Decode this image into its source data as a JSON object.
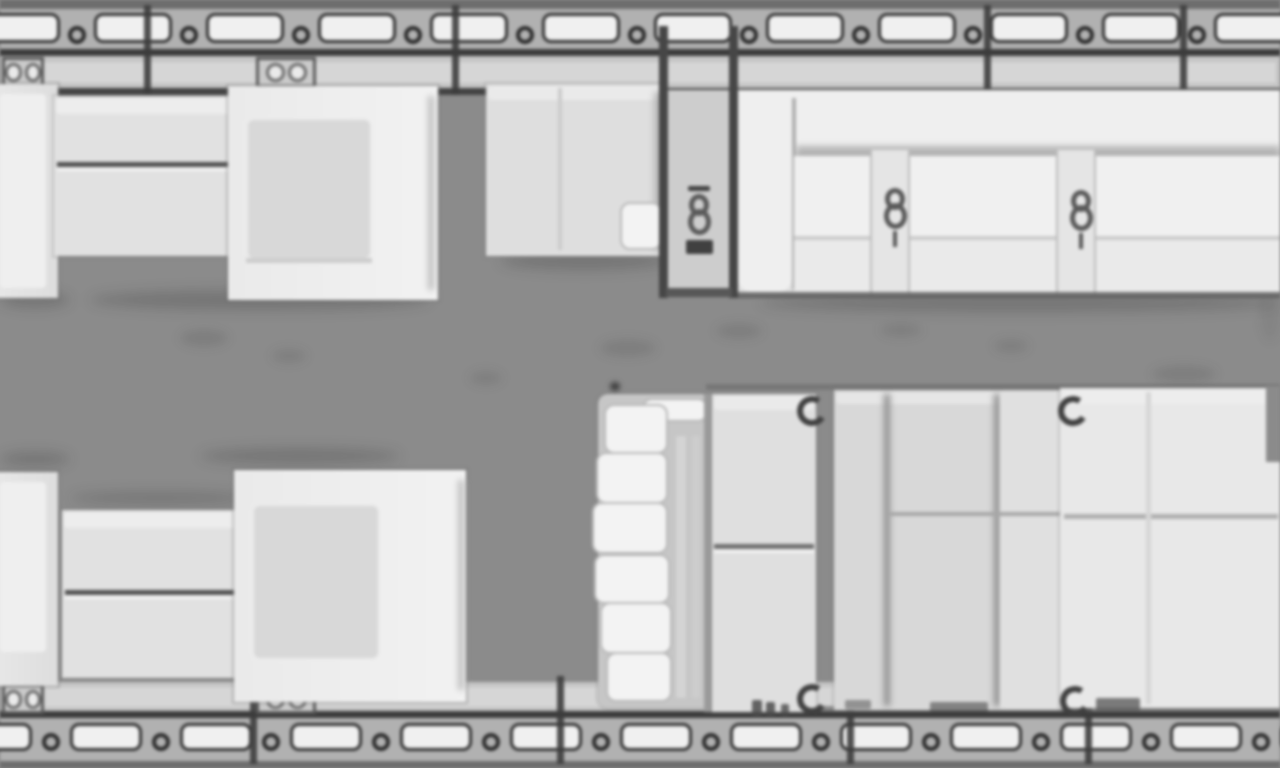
{
  "meta": {
    "description": "Top-down floor plan of a business-jet cabin (blurry upscaled grayscale plan, no text)",
    "orientation": "horizontal fuselage, windows along top and bottom walls"
  },
  "palette": {
    "floor": "#8b8b8b",
    "wall_dark": "#3b3b3b",
    "window_band": "#b2b2b2",
    "window_fill": "#f2f2f2",
    "sill": "#c6c6c6",
    "furniture_light": "#eeeeee",
    "furniture_mid": "#dadada",
    "partition": "#454545"
  },
  "plan": {
    "width": 1280,
    "height": 768,
    "windows": {
      "top": {
        "y": 13,
        "h": 30,
        "start": -18,
        "pitch": 112,
        "width": 78,
        "count": 12,
        "bracket_y": 26
      },
      "bottom": {
        "y": 723,
        "h": 28,
        "start": -40,
        "pitch": 110,
        "width": 72,
        "count": 13,
        "bracket_y": 733
      }
    },
    "frames": {
      "top": {
        "y": 5,
        "h": 90,
        "w": 7,
        "xs": [
          144,
          452,
          984,
          1180
        ]
      },
      "bottom": {
        "y": 676,
        "h": 88,
        "w": 7,
        "xs": [
          250,
          557,
          847,
          1085
        ]
      }
    },
    "base": [
      {
        "n": "fuselage-top-outer-edge",
        "k": "rect",
        "x": 0,
        "y": 0,
        "w": 1280,
        "h": 9,
        "bg": "#6d6d6d"
      },
      {
        "n": "fuselage-top-window-band",
        "k": "rect",
        "x": 0,
        "y": 9,
        "w": 1280,
        "h": 42,
        "bg": "#b2b2b2"
      },
      {
        "n": "fuselage-top-wall-line",
        "k": "rect",
        "x": 0,
        "y": 49,
        "w": 1280,
        "h": 8,
        "bg": "#3b3b3b"
      },
      {
        "n": "fuselage-top-sill",
        "k": "rect",
        "x": 0,
        "y": 56,
        "w": 1280,
        "h": 34,
        "bg": "#c6c6c6"
      },
      {
        "n": "fuselage-top-sill-inner",
        "k": "rect",
        "x": 4,
        "y": 62,
        "w": 1272,
        "h": 21,
        "bg": "#d8d8d8"
      },
      {
        "n": "fuselage-top-inner-line",
        "k": "rect",
        "x": 0,
        "y": 88,
        "w": 1280,
        "h": 7,
        "bg": "#424242"
      },
      {
        "n": "fuselage-bottom-sill",
        "k": "rect",
        "x": 0,
        "y": 682,
        "w": 1280,
        "h": 31,
        "bg": "#c6c6c6"
      },
      {
        "n": "fuselage-bottom-sill-inner",
        "k": "rect",
        "x": 4,
        "y": 687,
        "w": 1272,
        "h": 20,
        "bg": "#d8d8d8"
      },
      {
        "n": "fuselage-bottom-wall-line",
        "k": "rect",
        "x": 0,
        "y": 711,
        "w": 1280,
        "h": 8,
        "bg": "#3b3b3b"
      },
      {
        "n": "fuselage-bottom-window-band",
        "k": "rect",
        "x": 0,
        "y": 718,
        "w": 1280,
        "h": 45,
        "bg": "#b2b2b2"
      },
      {
        "n": "fuselage-bottom-outer-edge",
        "k": "rect",
        "x": 0,
        "y": 761,
        "w": 1280,
        "h": 7,
        "bg": "#6d6d6d"
      }
    ],
    "fittings": [
      {
        "n": "sidewall-fitting-top-left",
        "k": "fit",
        "x": 2,
        "y": 57,
        "w": 42,
        "h": 31
      },
      {
        "n": "sidewall-fitting-top-mid",
        "k": "fit",
        "x": 256,
        "y": 57,
        "w": 60,
        "h": 31
      },
      {
        "n": "sidewall-fitting-bottom-left",
        "k": "fit",
        "x": 2,
        "y": 684,
        "w": 42,
        "h": 30
      },
      {
        "n": "sidewall-fitting-bottom-mid",
        "k": "fit",
        "x": 256,
        "y": 684,
        "w": 60,
        "h": 30
      }
    ],
    "smudges": [
      {
        "n": "floor-smudge",
        "k": "smudge",
        "x": 180,
        "y": 330,
        "w": 48,
        "h": 16
      },
      {
        "n": "floor-smudge",
        "k": "smudge",
        "x": 272,
        "y": 350,
        "w": 34,
        "h": 12
      },
      {
        "n": "floor-smudge",
        "k": "smudge",
        "x": 470,
        "y": 372,
        "w": 32,
        "h": 12
      },
      {
        "n": "floor-smudge",
        "k": "smudge",
        "x": 600,
        "y": 340,
        "w": 56,
        "h": 16
      },
      {
        "n": "floor-smudge",
        "k": "smudge",
        "x": 716,
        "y": 324,
        "w": 46,
        "h": 14
      },
      {
        "n": "floor-smudge",
        "k": "smudge",
        "x": 880,
        "y": 324,
        "w": 42,
        "h": 12
      },
      {
        "n": "floor-smudge",
        "k": "smudge",
        "x": 994,
        "y": 340,
        "w": 34,
        "h": 12
      },
      {
        "n": "floor-smudge",
        "k": "smudge",
        "x": 1152,
        "y": 366,
        "w": 64,
        "h": 16
      },
      {
        "n": "floor-smudge",
        "k": "smudge",
        "x": 1260,
        "y": 282,
        "w": 20,
        "h": 60,
        "o": 0.5
      },
      {
        "n": "floor-speck",
        "k": "dot",
        "x": 610,
        "y": 382,
        "w": 10,
        "h": 9
      }
    ],
    "shadows": [
      {
        "n": "shadow-under-forward-table",
        "k": "shadow",
        "x": 90,
        "y": 290,
        "w": 340,
        "h": 20
      },
      {
        "n": "shadow-under-credenza",
        "k": "shadow",
        "x": 500,
        "y": 252,
        "w": 170,
        "h": 18
      },
      {
        "n": "shadow-under-divan",
        "k": "shadow",
        "x": 760,
        "y": 294,
        "w": 520,
        "h": 18
      },
      {
        "n": "shadow-above-aft-seat",
        "k": "shadow",
        "x": 200,
        "y": 448,
        "w": 200,
        "h": 16
      },
      {
        "n": "shadow-under-forward-left-seat",
        "k": "shadow",
        "x": 0,
        "y": 292,
        "w": 70,
        "h": 16
      },
      {
        "n": "shadow-above-aft-left-seat",
        "k": "shadow",
        "x": 0,
        "y": 452,
        "w": 70,
        "h": 14
      },
      {
        "n": "shadow-above-aft-table",
        "k": "shadow",
        "x": 70,
        "y": 492,
        "w": 180,
        "h": 12
      },
      {
        "n": "edge-line-above-bed-group",
        "k": "rect",
        "x": 706,
        "y": 384,
        "w": 574,
        "h": 6,
        "bg": "#6a6a6a",
        "o": 0.6
      },
      {
        "n": "edge-line-below-bed-group",
        "k": "rect",
        "x": 706,
        "y": 706,
        "w": 574,
        "h": 6,
        "bg": "#5f5f5f",
        "o": 0.6
      }
    ],
    "furniture": [
      {
        "n": "forward-left-seat-shell",
        "k": "shell",
        "x": -48,
        "y": 84,
        "w": 106,
        "h": 214,
        "r": "0 24 24 0",
        "bg": "linear-gradient(90deg,#f0f0f0,#dfdfdf)"
      },
      {
        "n": "forward-left-seat-cushion",
        "k": "bright",
        "x": 0,
        "y": 94,
        "w": 46,
        "h": 194,
        "o": 0.95
      },
      {
        "n": "forward-table-edge-shadow",
        "k": "soft",
        "x": 242,
        "y": 104,
        "w": 16,
        "h": 150,
        "bg": "#858585",
        "o": 0.6
      },
      {
        "n": "forward-table-top",
        "k": "panel",
        "x": 54,
        "y": 96,
        "w": 192,
        "h": 160,
        "bg": "#e3e3e3"
      },
      {
        "n": "forward-table-highlight",
        "k": "bright",
        "x": 56,
        "y": 98,
        "w": 188,
        "h": 16,
        "o": 0.8
      },
      {
        "n": "forward-table-split-seam",
        "k": "seam",
        "x": 57,
        "y": 162,
        "w": 186,
        "h": 5
      },
      {
        "n": "forward-table-split-light",
        "k": "seamlight",
        "x": 57,
        "y": 167,
        "w": 186,
        "h": 4
      },
      {
        "n": "forward-club-seat-shell",
        "k": "shell",
        "x": 228,
        "y": 86,
        "w": 210,
        "h": 214,
        "r": "12 28 28 12",
        "bg": "linear-gradient(90deg,#ececec,#f4f4f4)"
      },
      {
        "n": "forward-club-seat-cushion",
        "k": "cushion",
        "x": 246,
        "y": 118,
        "w": 126,
        "h": 142
      },
      {
        "n": "forward-club-seat-backline",
        "k": "soft",
        "x": 428,
        "y": 96,
        "w": 6,
        "h": 194,
        "bg": "#c0c0c0"
      },
      {
        "n": "forward-club-seat-frontline",
        "k": "rect",
        "x": 246,
        "y": 258,
        "w": 126,
        "h": 5,
        "bg": "#cfcfcf"
      },
      {
        "n": "galley-credenza",
        "k": "panel",
        "x": 486,
        "y": 84,
        "w": 178,
        "h": 172,
        "bg": "#e0e0e0"
      },
      {
        "n": "galley-credenza-highlight",
        "k": "bright",
        "x": 488,
        "y": 86,
        "w": 174,
        "h": 14,
        "o": 0.7
      },
      {
        "n": "galley-credenza-edge-shadow",
        "k": "soft",
        "x": 654,
        "y": 92,
        "w": 14,
        "h": 158,
        "bg": "#9a9a9a",
        "o": 0.6
      },
      {
        "n": "galley-credenza-seam",
        "k": "rect",
        "x": 558,
        "y": 88,
        "w": 4,
        "h": 162,
        "bg": "#cdcdcd"
      },
      {
        "n": "galley-credenza-cabinet-door",
        "k": "step",
        "x": 620,
        "y": 202,
        "w": 42,
        "h": 48
      },
      {
        "n": "emergency-exit-bay",
        "k": "rect",
        "x": 668,
        "y": 90,
        "w": 66,
        "h": 206,
        "bg": "#cfcfcf"
      },
      {
        "n": "divan-base",
        "k": "panel",
        "x": 736,
        "y": 90,
        "w": 544,
        "h": 206,
        "bg": "#e4e4e4"
      },
      {
        "n": "divan-backrest",
        "k": "bright",
        "x": 736,
        "y": 90,
        "w": 544,
        "h": 62,
        "o": 1
      },
      {
        "n": "divan-back-crease",
        "k": "soft",
        "x": 796,
        "y": 146,
        "w": 484,
        "h": 14,
        "bg": "#a8a8a8",
        "o": 0.8
      },
      {
        "n": "divan-armrest-left",
        "k": "bright",
        "x": 738,
        "y": 94,
        "w": 54,
        "h": 198,
        "r": "14",
        "o": 1
      },
      {
        "n": "divan-armrest-seam",
        "k": "rect",
        "x": 792,
        "y": 98,
        "w": 4,
        "h": 192,
        "bg": "#b0b0b0"
      },
      {
        "n": "divan-seat-cushion",
        "k": "rect",
        "x": 794,
        "y": 156,
        "w": 486,
        "h": 80,
        "bg": "#f2f2f2"
      },
      {
        "n": "divan-front-edge-line",
        "k": "rect",
        "x": 794,
        "y": 236,
        "w": 486,
        "h": 4,
        "bg": "#cdcdcd"
      },
      {
        "n": "divan-front-rail",
        "k": "rect",
        "x": 794,
        "y": 240,
        "w": 486,
        "h": 52,
        "bg": "#ececec"
      },
      {
        "n": "divan-seat-divider-1",
        "k": "divider",
        "x": 870,
        "y": 150,
        "w": 40,
        "h": 144
      },
      {
        "n": "divan-seat-divider-2",
        "k": "divider",
        "x": 1056,
        "y": 150,
        "w": 40,
        "h": 144
      },
      {
        "n": "divan-bottom-line",
        "k": "rect",
        "x": 736,
        "y": 292,
        "w": 544,
        "h": 6,
        "bg": "#565656",
        "o": 0.8
      },
      {
        "n": "aft-left-seat-shell",
        "k": "shell",
        "x": -48,
        "y": 472,
        "w": 106,
        "h": 214,
        "r": "0 24 24 0",
        "bg": "linear-gradient(90deg,#f0f0f0,#dfdfdf)"
      },
      {
        "n": "aft-left-seat-cushion",
        "k": "bright",
        "x": 0,
        "y": 482,
        "w": 46,
        "h": 170,
        "o": 0.95
      },
      {
        "n": "aft-table-edge-shadow",
        "k": "soft",
        "x": 240,
        "y": 516,
        "w": 16,
        "h": 150,
        "bg": "#858585",
        "o": 0.6
      },
      {
        "n": "aft-table-top",
        "k": "panel",
        "x": 62,
        "y": 510,
        "w": 184,
        "h": 168,
        "bg": "#e3e3e3"
      },
      {
        "n": "aft-table-highlight",
        "k": "bright",
        "x": 64,
        "y": 512,
        "w": 180,
        "h": 16,
        "o": 0.8
      },
      {
        "n": "aft-table-split-seam",
        "k": "seam",
        "x": 65,
        "y": 590,
        "w": 178,
        "h": 5
      },
      {
        "n": "aft-table-split-light",
        "k": "seamlight",
        "x": 65,
        "y": 595,
        "w": 178,
        "h": 4
      },
      {
        "n": "aft-club-seat-shell",
        "k": "shell",
        "x": 234,
        "y": 470,
        "w": 232,
        "h": 232,
        "r": "12 30 30 12",
        "bg": "linear-gradient(90deg,#ececec,#f4f4f4)"
      },
      {
        "n": "aft-club-seat-cushion",
        "k": "cushion",
        "x": 252,
        "y": 504,
        "w": 128,
        "h": 156
      },
      {
        "n": "aft-club-seat-backline",
        "k": "soft",
        "x": 458,
        "y": 480,
        "w": 6,
        "h": 210,
        "bg": "#c0c0c0"
      },
      {
        "n": "stair-unit-base",
        "k": "panel",
        "x": 598,
        "y": 394,
        "w": 114,
        "h": 314,
        "bg": "#c7c7c7",
        "r": "10"
      },
      {
        "n": "stair-unit-stripe",
        "k": "rect",
        "x": 676,
        "y": 436,
        "w": 10,
        "h": 262,
        "bg": "#d6d6d6"
      },
      {
        "n": "stair-unit-stripe",
        "k": "rect",
        "x": 692,
        "y": 436,
        "w": 8,
        "h": 262,
        "bg": "#cfcfcf"
      },
      {
        "n": "stair-top-cap",
        "k": "step",
        "x": 642,
        "y": 398,
        "w": 66,
        "h": 24
      },
      {
        "n": "stair-step-1",
        "k": "step",
        "x": 604,
        "y": 404,
        "w": 64,
        "h": 50
      },
      {
        "n": "stair-step-2",
        "k": "step",
        "x": 596,
        "y": 452,
        "w": 72,
        "h": 52
      },
      {
        "n": "stair-step-3",
        "k": "step",
        "x": 592,
        "y": 502,
        "w": 76,
        "h": 52
      },
      {
        "n": "stair-step-4",
        "k": "step",
        "x": 594,
        "y": 554,
        "w": 76,
        "h": 50
      },
      {
        "n": "stair-step-5",
        "k": "step",
        "x": 600,
        "y": 602,
        "w": 72,
        "h": 52
      },
      {
        "n": "stair-step-6",
        "k": "step",
        "x": 606,
        "y": 652,
        "w": 66,
        "h": 50
      },
      {
        "n": "aft-cabinet-dark-edge",
        "k": "rect",
        "x": 704,
        "y": 394,
        "w": 10,
        "h": 318,
        "bg": "#9c9c9c"
      },
      {
        "n": "aft-cabinet-panel",
        "k": "panel",
        "x": 712,
        "y": 394,
        "w": 104,
        "h": 318,
        "bg": "#e1e1e1"
      },
      {
        "n": "aft-cabinet-highlight",
        "k": "bright",
        "x": 714,
        "y": 396,
        "w": 100,
        "h": 14,
        "o": 0.7
      },
      {
        "n": "aft-cabinet-seam",
        "k": "rect",
        "x": 714,
        "y": 544,
        "w": 100,
        "h": 5,
        "bg": "#6f6f6f"
      },
      {
        "n": "aft-cabinet-seam-light",
        "k": "seamlight",
        "x": 714,
        "y": 549,
        "w": 100,
        "h": 4
      },
      {
        "n": "aft-sofa-base",
        "k": "panel",
        "x": 834,
        "y": 390,
        "w": 228,
        "h": 320,
        "bg": "#dadada"
      },
      {
        "n": "aft-sofa-highlight",
        "k": "bright",
        "x": 836,
        "y": 392,
        "w": 224,
        "h": 12,
        "o": 0.6
      },
      {
        "n": "aft-sofa-vseam-1",
        "k": "soft",
        "x": 884,
        "y": 394,
        "w": 6,
        "h": 312,
        "bg": "#8d8d8d"
      },
      {
        "n": "aft-sofa-vseam-2",
        "k": "soft",
        "x": 994,
        "y": 394,
        "w": 6,
        "h": 312,
        "bg": "#8d8d8d"
      },
      {
        "n": "aft-sofa-right-cushion",
        "k": "rect",
        "x": 1000,
        "y": 392,
        "w": 62,
        "h": 316,
        "bg": "#e2e2e2"
      },
      {
        "n": "aft-sofa-hseam",
        "k": "rect",
        "x": 890,
        "y": 512,
        "w": 170,
        "h": 4,
        "bg": "#a8a8a8"
      },
      {
        "n": "bed-mattress",
        "k": "panel",
        "x": 1060,
        "y": 388,
        "w": 220,
        "h": 320,
        "bg": "#eaeaea",
        "r": "16 0 0 16"
      },
      {
        "n": "bed-mattress-highlight",
        "k": "bright",
        "x": 1062,
        "y": 390,
        "w": 216,
        "h": 14,
        "o": 0.6
      },
      {
        "n": "bed-mattress-seam",
        "k": "rect",
        "x": 1064,
        "y": 514,
        "w": 214,
        "h": 5,
        "bg": "#b0b0b0"
      },
      {
        "n": "bed-mattress-crease",
        "k": "rect",
        "x": 1146,
        "y": 392,
        "w": 5,
        "h": 312,
        "bg": "#d8d8d8"
      },
      {
        "n": "bed-corner-notch",
        "k": "rect",
        "x": 1266,
        "y": 386,
        "w": 14,
        "h": 76,
        "bg": "#8b8b8b"
      }
    ],
    "partitions": [
      {
        "n": "cabin-partition-left",
        "k": "partition",
        "x": 659,
        "y": 26,
        "w": 9,
        "h": 272
      },
      {
        "n": "cabin-partition-right",
        "k": "partition",
        "x": 729,
        "y": 26,
        "w": 9,
        "h": 272
      },
      {
        "n": "cabin-partition-foot-bar",
        "k": "rect",
        "x": 666,
        "y": 288,
        "w": 66,
        "h": 9,
        "bg": "#565656"
      }
    ],
    "symbols": [
      {
        "n": "table-mount-ring",
        "k": "ring",
        "x": 797,
        "y": 396,
        "w": 30,
        "h": 30
      },
      {
        "n": "table-mount-ring",
        "k": "ring",
        "x": 797,
        "y": 684,
        "w": 30,
        "h": 30
      },
      {
        "n": "table-mount-ring",
        "k": "ring",
        "x": 1058,
        "y": 396,
        "w": 30,
        "h": 30
      },
      {
        "n": "table-mount-ring",
        "k": "ring",
        "x": 1060,
        "y": 686,
        "w": 30,
        "h": 30
      },
      {
        "n": "exit-seatbelt-icon",
        "k": "belt",
        "x": 684,
        "y": 186,
        "w": 30,
        "h": 100,
        "v": "exit"
      },
      {
        "n": "divan-seatbelt-icon-1",
        "k": "belt",
        "x": 878,
        "y": 188,
        "w": 34,
        "h": 100,
        "v": "divan"
      },
      {
        "n": "divan-seatbelt-icon-2",
        "k": "belt",
        "x": 1064,
        "y": 190,
        "w": 34,
        "h": 100,
        "v": "divan"
      }
    ],
    "marks": [
      {
        "n": "floor-fitting-mark",
        "k": "bar",
        "x": 752,
        "y": 700,
        "w": 10,
        "h": 16,
        "o": 0.85
      },
      {
        "n": "floor-fitting-mark",
        "k": "bar",
        "x": 766,
        "y": 702,
        "w": 9,
        "h": 14,
        "o": 0.85
      },
      {
        "n": "floor-fitting-mark",
        "k": "bar",
        "x": 781,
        "y": 704,
        "w": 8,
        "h": 12,
        "o": 0.8
      },
      {
        "n": "floor-fitting-mark",
        "k": "bar",
        "x": 845,
        "y": 700,
        "w": 26,
        "h": 9,
        "o": 0.5
      },
      {
        "n": "floor-fitting-mark",
        "k": "bar",
        "x": 930,
        "y": 702,
        "w": 58,
        "h": 10,
        "o": 0.6
      },
      {
        "n": "floor-fitting-mark",
        "k": "bar",
        "x": 1096,
        "y": 698,
        "w": 44,
        "h": 12,
        "o": 0.7
      }
    ]
  }
}
